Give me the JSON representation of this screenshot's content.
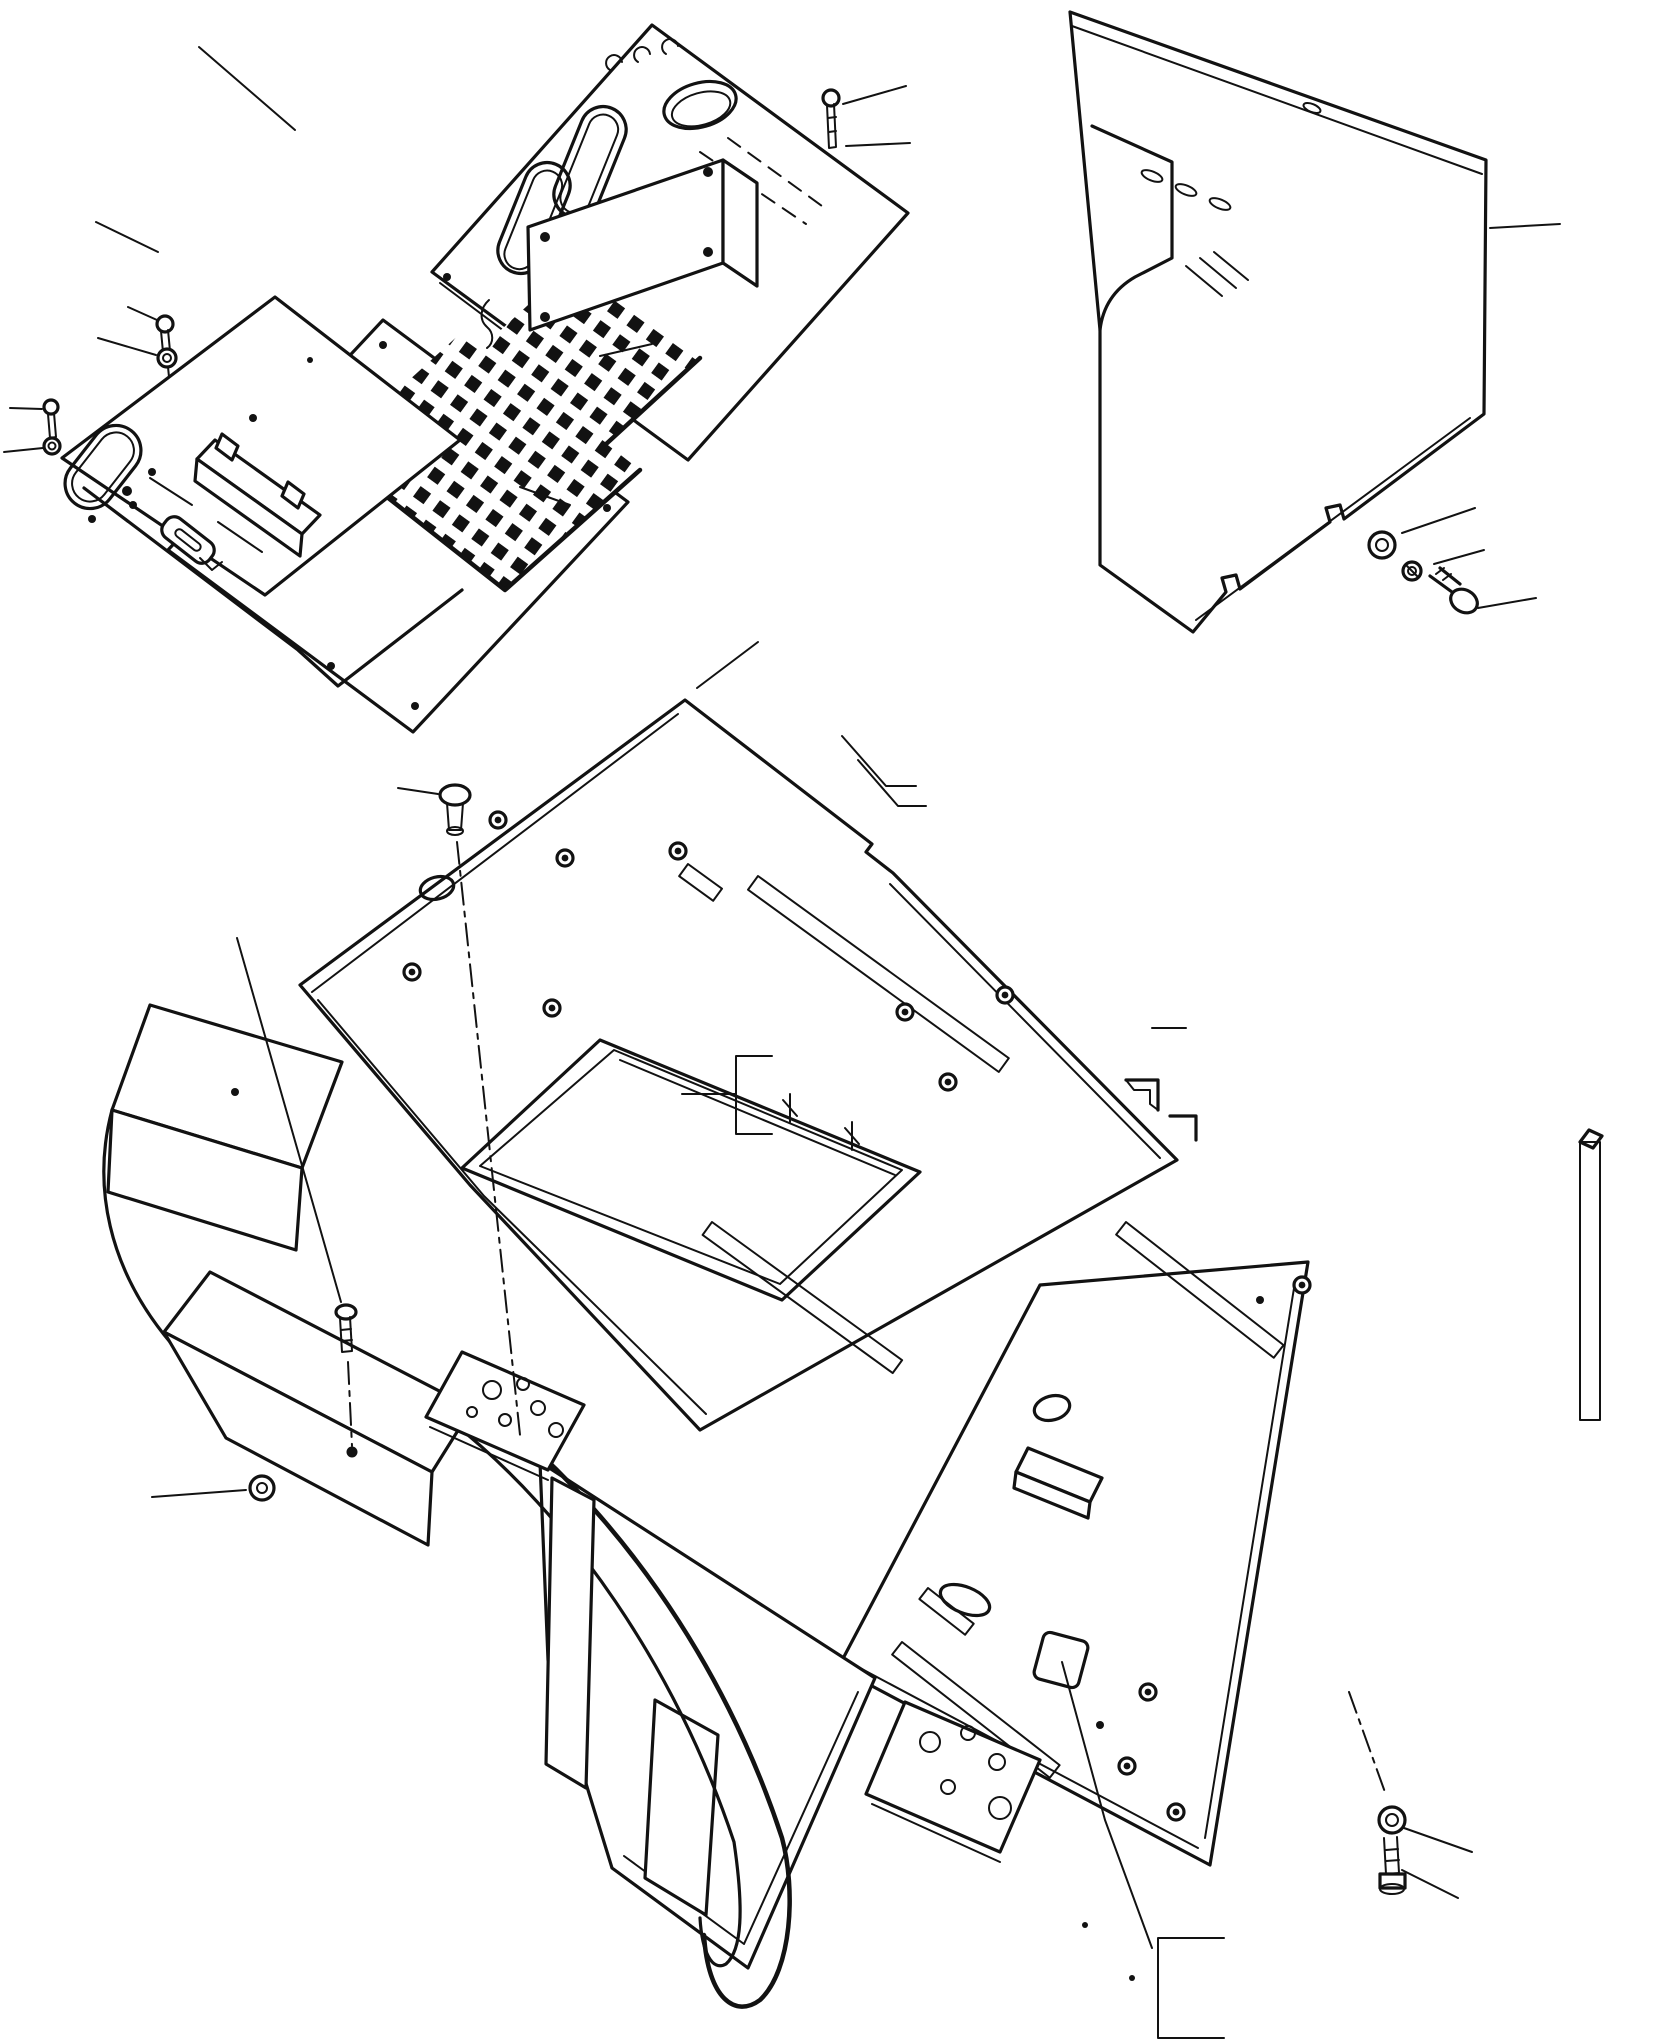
{
  "document": {
    "type": "exploded-parts-diagram",
    "style": "isometric black line art on white, parts-catalog plate",
    "visible_text": "none"
  },
  "colors": {
    "background": "#ffffff",
    "line": "#121212"
  },
  "groups": [
    {
      "id": "upper-left",
      "name": "control panel, plates and floor mats",
      "parts": [
        "instrument cover panel with round hole, two slotted openings, three louver vents and dashed fold lines",
        "small access cover with four corner screw holes",
        "blank mounting plate with corner screw holes",
        "bracket plate with oval cutout, small holes, guide channel with tabs and slotted slide piece",
        "stacked lower plate (offset duplicate outline)",
        "waffle-textured floor mat, upper",
        "waffle-textured floor mat, lower",
        "small S-hook",
        "three screw-and-washer sets"
      ]
    },
    {
      "id": "upper-right",
      "name": "side cover and hardware",
      "parts": [
        "tall side cover with stepped fold at upper left, three louver slots, small oval hole and two notched tabs on bottom edge",
        "flat washer",
        "spring washer",
        "hex bolt"
      ]
    },
    {
      "id": "lower",
      "name": "floor frame assembly",
      "parts": [
        "floor frame deck with rectangular opening and rim rails",
        "right floor plate with round, oval and square cutouts",
        "front apron plate",
        "seat bracket box with support arm",
        "curved guard rail (J-shaped)",
        "support pillar",
        "perforated plate with six holes",
        "pedal plate with five holes",
        "rubber knob (press fitting)",
        "hex mounting bolt",
        "grommet washer",
        "seven adhesive seal strips (speckled texture)",
        "grommets and screw holes across deck",
        "flat washer and hex bolt at lower right"
      ]
    }
  ],
  "callouts": {
    "leader_lines": 24,
    "group_brackets": 2,
    "dash_dot_centerlines": 4,
    "labels": "none (blank leader lines, callout numbers not shown)"
  }
}
